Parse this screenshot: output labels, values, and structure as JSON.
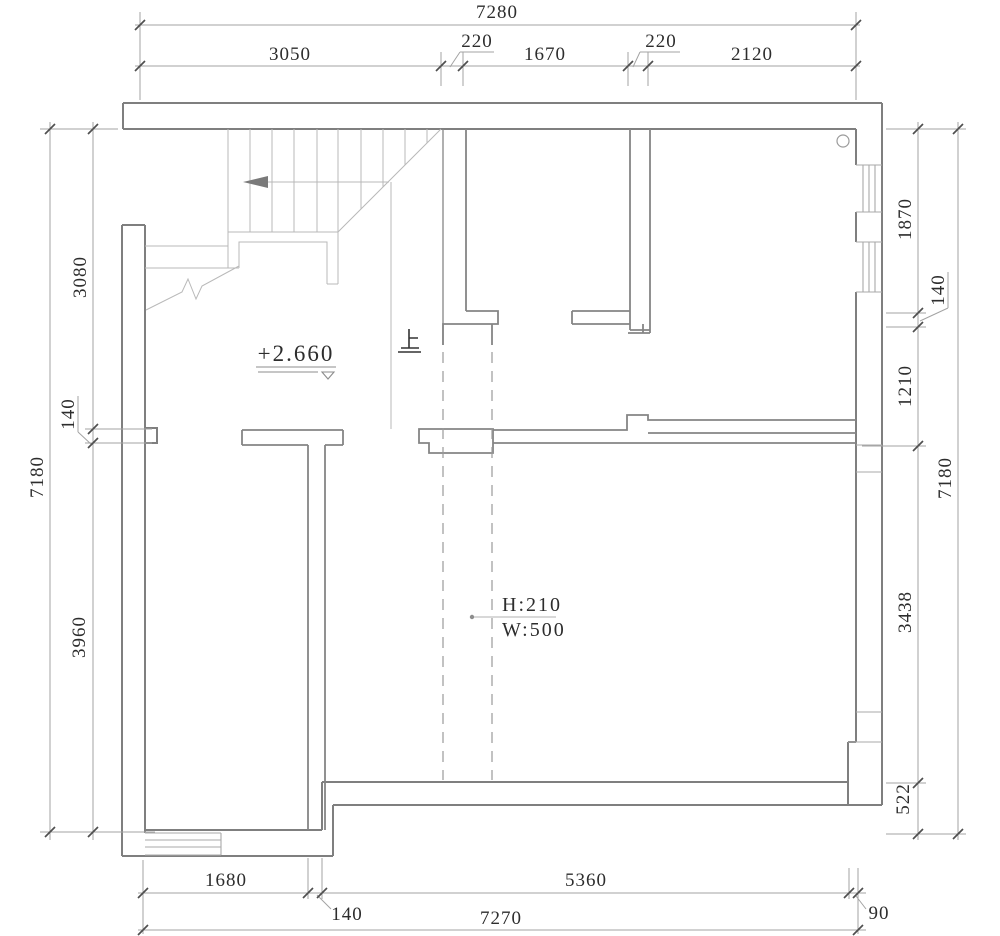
{
  "plan": {
    "level_annotation": "+2.660",
    "stairs_up_label": "上",
    "opening_annotation": {
      "height": "H:210",
      "width": "W:500"
    },
    "dimensions": {
      "top": {
        "total": "7280",
        "segments": [
          "3050",
          "220",
          "1670",
          "220",
          "2120"
        ]
      },
      "bottom": {
        "total": "7270",
        "segments": [
          "1680",
          "140",
          "5360",
          "90"
        ]
      },
      "left": {
        "total": "7180",
        "segments": [
          "3080",
          "140",
          "3960"
        ]
      },
      "right": {
        "total": "7180",
        "segments": [
          "1870",
          "140",
          "1210",
          "3438",
          "522"
        ]
      }
    }
  }
}
